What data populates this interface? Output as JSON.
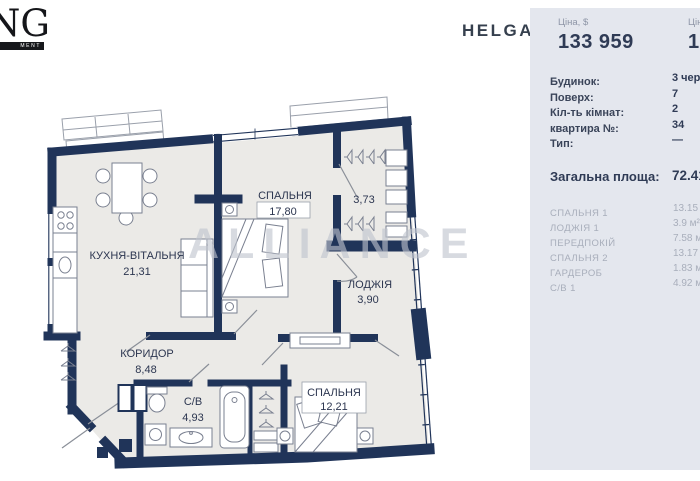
{
  "brand": {
    "logo_text": "NG",
    "logo_bar_text": "MENT",
    "project_name": "HELGA"
  },
  "watermark": {
    "text": "ALLIANCE"
  },
  "panel": {
    "price_usd": {
      "label": "Ціна, $",
      "value": "133 959"
    },
    "price_per_m2": {
      "label": "Ціна за м²",
      "value": "1 850"
    },
    "details": [
      {
        "label": "Будинок:",
        "value": "3 черга"
      },
      {
        "label": "Поверх:",
        "value": "7"
      },
      {
        "label": "Кіл-ть кімнат:",
        "value": "2"
      },
      {
        "label": "квартира №:",
        "value": "34"
      },
      {
        "label": "Тип:",
        "value": "—"
      }
    ],
    "total_area": {
      "label": "Загальна площа:",
      "value": "72.41 м²"
    },
    "rooms": [
      {
        "label": "СПАЛЬНЯ 1",
        "value": "13.15 м²"
      },
      {
        "label": "ЛОДЖІЯ 1",
        "value": "3.9 м²"
      },
      {
        "label": "ПЕРЕДПОКІЙ",
        "value": "7.58 м²"
      },
      {
        "label": "СПАЛЬНЯ 2",
        "value": "13.17 м²"
      },
      {
        "label": "ГАРДЕРОБ",
        "value": "1.83 м²"
      },
      {
        "label": "С/В 1",
        "value": "4.92 м²"
      }
    ]
  },
  "floorplan": {
    "rooms": [
      {
        "name": "КУХНЯ-ВІТАЛЬНЯ",
        "area": "21,31"
      },
      {
        "name": "СПАЛЬНЯ",
        "area": "17,80"
      },
      {
        "name": "",
        "area": "3,73"
      },
      {
        "name": "ЛОДЖІЯ",
        "area": "3,90"
      },
      {
        "name": "КОРИДОР",
        "area": "8,48"
      },
      {
        "name": "С/В",
        "area": "4,93"
      },
      {
        "name": "СПАЛЬНЯ",
        "area": "12,21"
      }
    ],
    "colors": {
      "wall": "#203459",
      "floor": "#ebeae7",
      "furniture_line": "#7a8090"
    }
  }
}
